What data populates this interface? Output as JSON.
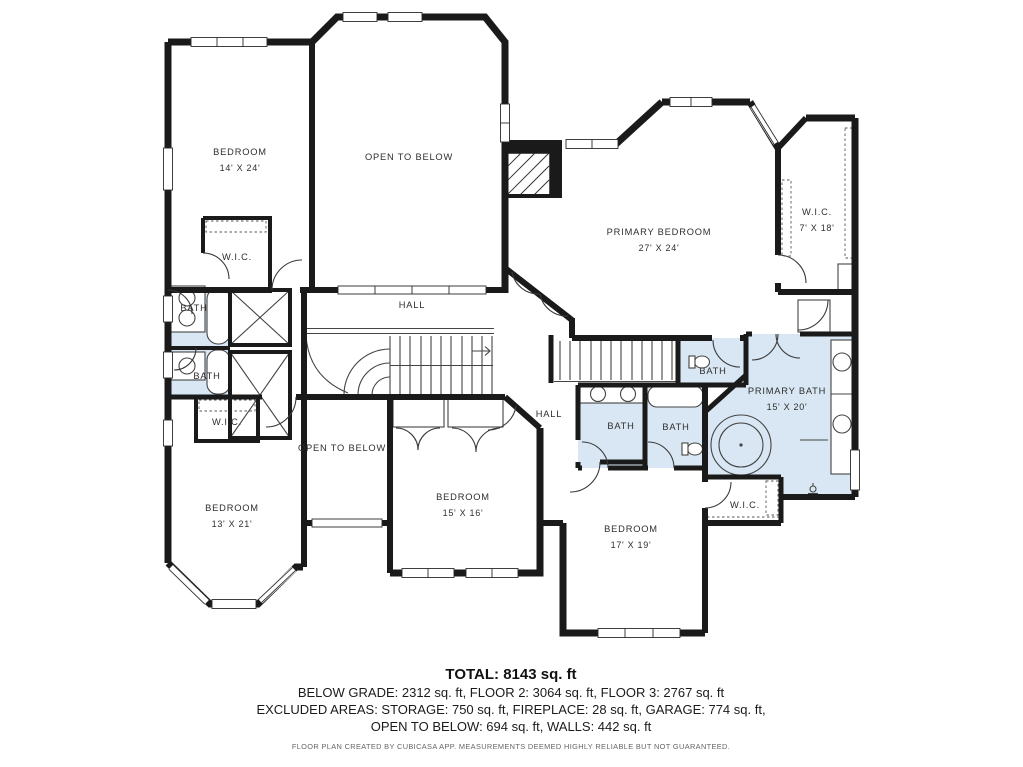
{
  "colors": {
    "wall": "#1a1a1a",
    "bath_fill": "#d8e7f3",
    "thin_line": "#444444",
    "label_text": "#2f2f2f"
  },
  "rooms": [
    {
      "label": "BEDROOM",
      "dims": "14' X 24'"
    },
    {
      "label": "OPEN TO BELOW",
      "dims": ""
    },
    {
      "label": "PRIMARY BEDROOM",
      "dims": "27' X 24'"
    },
    {
      "label": "W.I.C.",
      "dims": "7' X 18'"
    },
    {
      "label": "HALL",
      "dims": ""
    },
    {
      "label": "W.I.C.",
      "dims": ""
    },
    {
      "label": "BATH",
      "dims": ""
    },
    {
      "label": "BATH",
      "dims": ""
    },
    {
      "label": "W.I.C.",
      "dims": ""
    },
    {
      "label": "BATH",
      "dims": ""
    },
    {
      "label": "HALL",
      "dims": ""
    },
    {
      "label": "BATH",
      "dims": ""
    },
    {
      "label": "BATH",
      "dims": ""
    },
    {
      "label": "PRIMARY BATH",
      "dims": "15' X 20'"
    },
    {
      "label": "OPEN TO BELOW",
      "dims": ""
    },
    {
      "label": "BEDROOM",
      "dims": "13' X 21'"
    },
    {
      "label": "BEDROOM",
      "dims": "15' X 16'"
    },
    {
      "label": "BEDROOM",
      "dims": "17' X 19'"
    },
    {
      "label": "W.I.C.",
      "dims": ""
    }
  ],
  "summary": {
    "total": "TOTAL: 8143 sq. ft",
    "areas_line": "BELOW GRADE: 2312 sq. ft, FLOOR 2: 3064 sq. ft, FLOOR 3: 2767 sq. ft",
    "excluded_line": "EXCLUDED AREAS: STORAGE: 750 sq. ft, FIREPLACE: 28 sq. ft, GARAGE: 774 sq. ft,",
    "excluded_line2": "OPEN TO BELOW: 694 sq. ft, WALLS: 442 sq. ft",
    "disclaimer": "FLOOR PLAN CREATED BY CUBICASA APP. MEASUREMENTS DEEMED HIGHLY RELIABLE BUT NOT GUARANTEED."
  }
}
